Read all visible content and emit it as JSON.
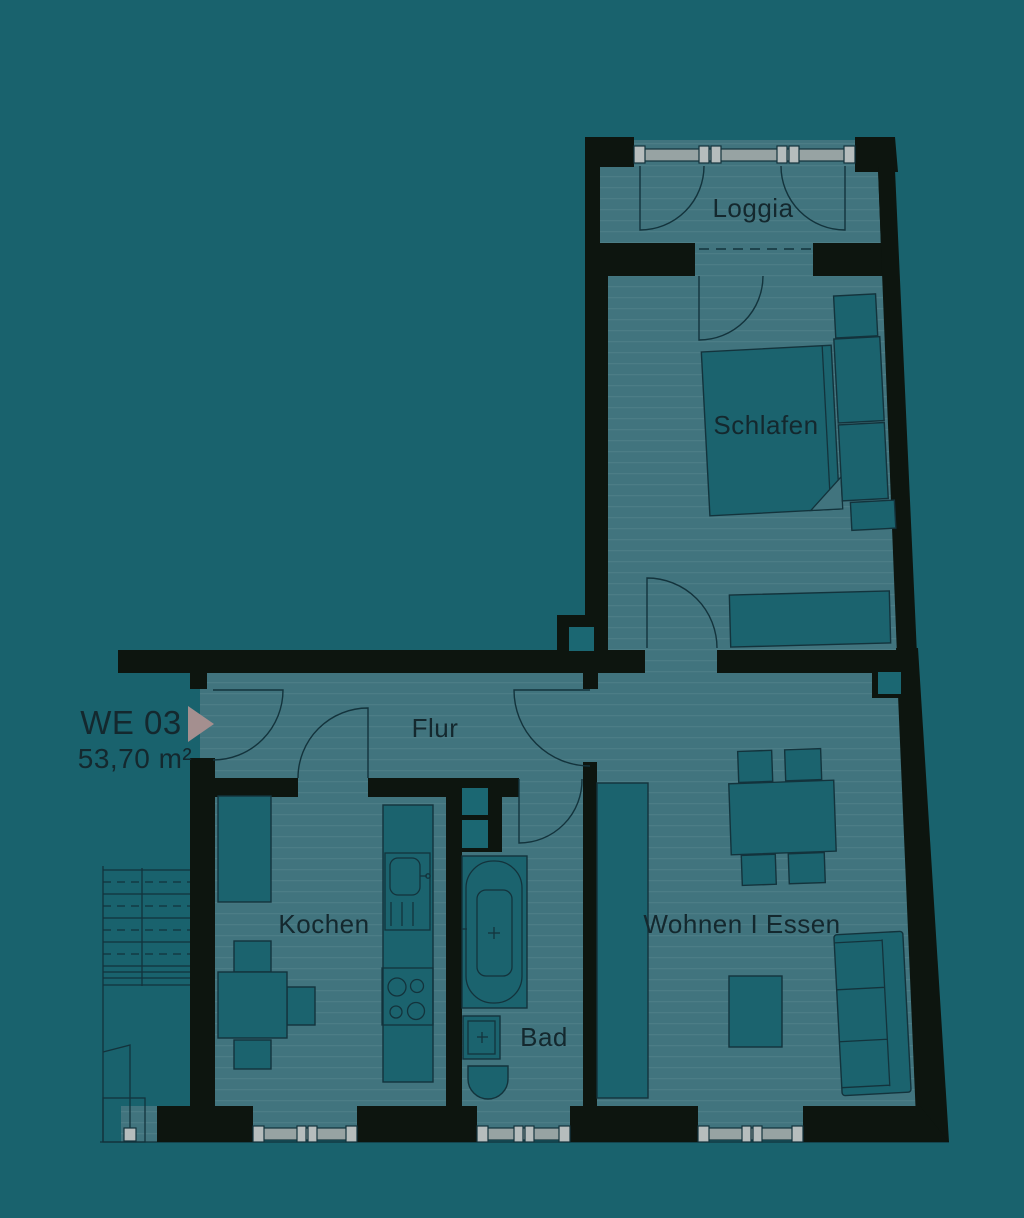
{
  "plan": {
    "unit_label": "WE 03",
    "unit_area": "53,70 m²",
    "rooms": [
      {
        "id": "loggia",
        "label": "Loggia"
      },
      {
        "id": "schlafen",
        "label": "Schlafen"
      },
      {
        "id": "flur",
        "label": "Flur"
      },
      {
        "id": "kochen",
        "label": "Kochen"
      },
      {
        "id": "bad",
        "label": "Bad"
      },
      {
        "id": "wohnen-essen",
        "label": "Wohnen I Essen"
      }
    ],
    "colors": {
      "background": "#19626d",
      "floor": "#41747e",
      "wall": "#0d150f",
      "furniture": "#1b636e",
      "outline": "#13333c",
      "window_gray": "#97a3a3",
      "window_post": "#b6bdbd",
      "shaft": "#1b6772",
      "arrow": "#a48f8f",
      "text": "#14282e"
    }
  }
}
